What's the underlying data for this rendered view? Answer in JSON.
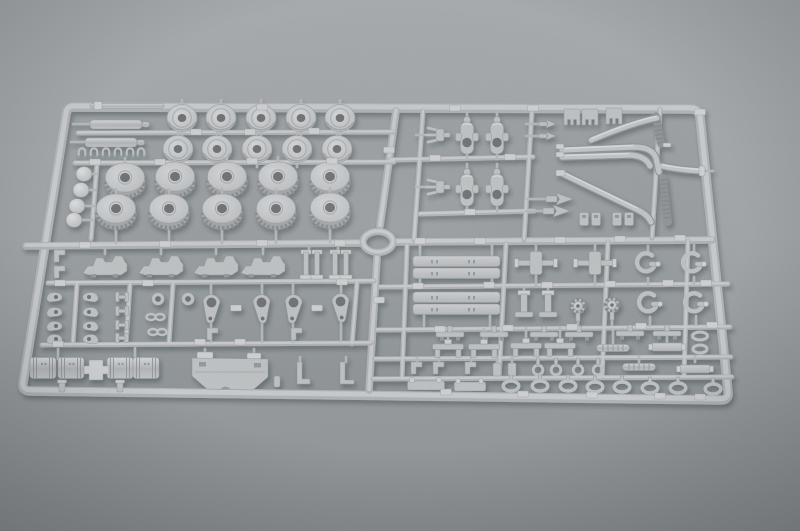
{
  "meta": {
    "domain": "natural-image",
    "alt": "Photograph of a light gray injection-molded plastic model kit sprue (parts tree) lying on a plain gray studio background, shot at a slight angle. The rectangular frame is divided into four quadrants by a central cross runner with a round ring at the intersection. The upper-left quadrant holds rows of road wheels and toothed drive sprockets plus two small gun barrels; the upper-right holds suspension crank plates and a cluster of curved exhaust pipes; the lower-left holds small hooks, teardrop-shaped swing-arm plates, drum housings and a hull plate; the lower-right holds long bars, tow hooks, pedestal mounts and rows of small loops and eyelets."
  },
  "scene": {
    "subject": "plastic model kit sprue with unassembled parts",
    "object_type": "injection-molded-sprue",
    "material": "light gray styrene plastic",
    "background": "neutral gray seamless backdrop, lighter at top, darkening toward the bottom corners",
    "layout": "rectangular outer frame, central vertical and horizontal runners crossing at a molded ring, four quadrants of parts connected by thin gates, small raised number tabs along the runners"
  },
  "colors": {
    "bg_top": "#adb1b4",
    "bg_mid": "#a7abae",
    "bg_bottom": "#93979a",
    "plastic_base": "#c6c9cb",
    "plastic_light": "#d6d8da",
    "plastic_edge": "#9aa0a3",
    "runner_base": "#b7babd",
    "runner_light": "#cfd2d4",
    "tab_light": "#d6d8da",
    "hole_dark": "#75797c",
    "skirt": "#abaeb1",
    "teeth_dark": "#8f9397",
    "pipe_dark": "#989ca0",
    "pipe_light": "#c9ccce",
    "shadow": "#22262a"
  },
  "part_groups": {
    "top_left": {
      "label": "wheels and barrels",
      "items": [
        {
          "name": "flat road wheel disc",
          "count": 10
        },
        {
          "name": "toothed drive sprocket",
          "count": 10
        },
        {
          "name": "gun barrel",
          "count": 2
        },
        {
          "name": "thin rod",
          "count": 1
        },
        {
          "name": "small clamp",
          "count": 6
        },
        {
          "name": "dome cap",
          "count": 4
        }
      ]
    },
    "top_right": {
      "label": "suspension cranks and exhaust pipes",
      "items": [
        {
          "name": "bell-crank plate",
          "count": 4
        },
        {
          "name": "fork bracket",
          "count": 2
        },
        {
          "name": "dart part",
          "count": 2
        },
        {
          "name": "notched bracket",
          "count": 3
        },
        {
          "name": "arrow wedge",
          "count": 2
        },
        {
          "name": "curved exhaust pipe",
          "count": 4
        },
        {
          "name": "small clip",
          "count": 4
        }
      ]
    },
    "bottom_left": {
      "label": "hull fittings and running gear",
      "items": [
        {
          "name": "fender plate",
          "count": 4
        },
        {
          "name": "post bracket",
          "count": 4
        },
        {
          "name": "hook part",
          "count": 8
        },
        {
          "name": "H-bracket",
          "count": 4
        },
        {
          "name": "ring grommet",
          "count": 2
        },
        {
          "name": "chain link",
          "count": 2
        },
        {
          "name": "teardrop swing-arm plate",
          "count": 4
        },
        {
          "name": "drum housing",
          "count": 4
        },
        {
          "name": "cross joint",
          "count": 1
        },
        {
          "name": "hull plate",
          "count": 1
        },
        {
          "name": "L-bracket",
          "count": 2
        }
      ]
    },
    "bottom_right": {
      "label": "beams, hooks and small fittings",
      "items": [
        {
          "name": "long beam",
          "count": 4
        },
        {
          "name": "axle cross mount",
          "count": 2
        },
        {
          "name": "clevis hook",
          "count": 4
        },
        {
          "name": "pedestal mount",
          "count": 2
        },
        {
          "name": "cap wheel",
          "count": 2
        },
        {
          "name": "T-hanger",
          "count": 6
        },
        {
          "name": "bench bracket",
          "count": 4
        },
        {
          "name": "ribbed rod",
          "count": 3
        },
        {
          "name": "eyelet",
          "count": 4
        },
        {
          "name": "oval tow loop",
          "count": 8
        },
        {
          "name": "base plate",
          "count": 2
        }
      ]
    },
    "hub": {
      "label": "center ring",
      "items": [
        {
          "name": "molded ring",
          "count": 1
        }
      ]
    }
  }
}
